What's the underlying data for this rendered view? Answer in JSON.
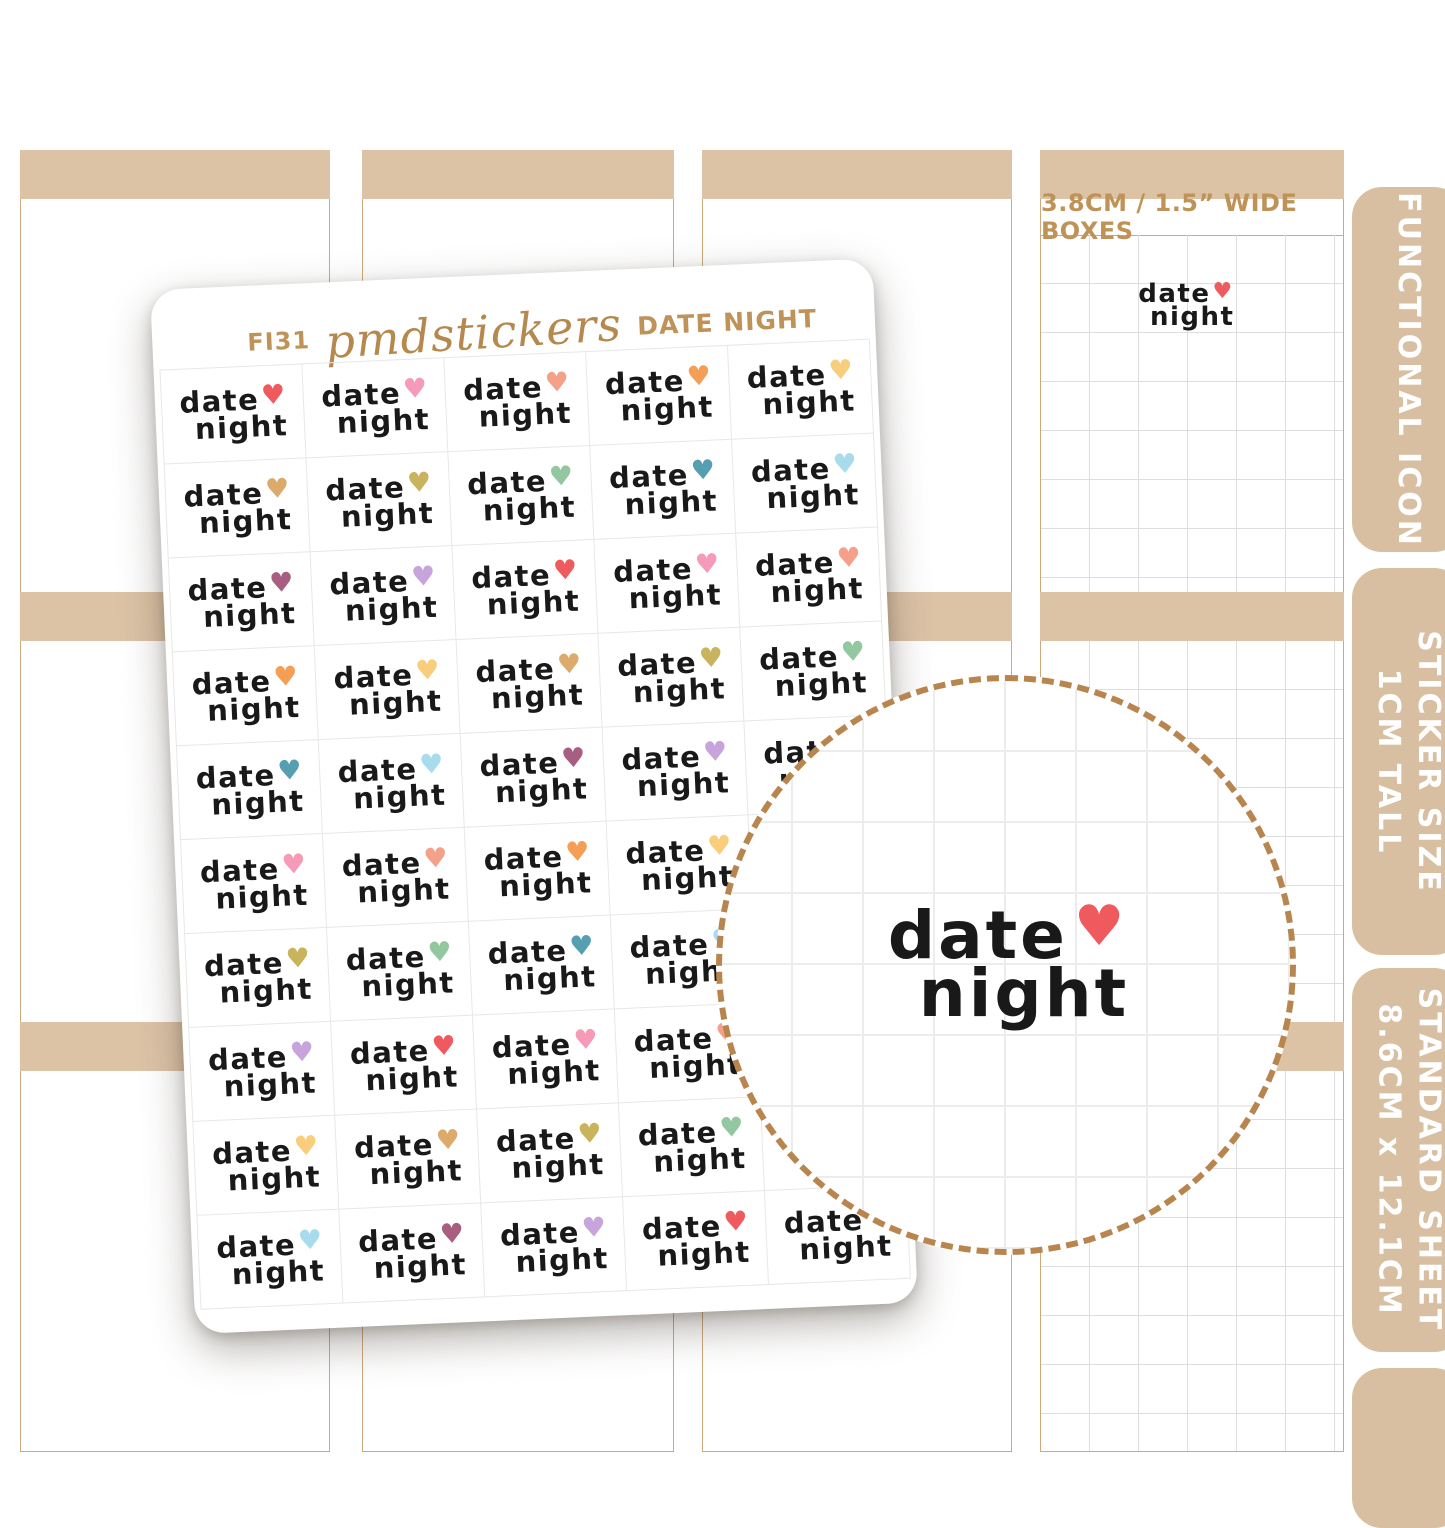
{
  "sheet": {
    "code": "FI31",
    "brand": "pmdstickers",
    "title": "DATE NIGHT",
    "sticker_text_line1": "date",
    "sticker_text_line2": "night",
    "rows": 10,
    "cols": 5,
    "heart_palette": {
      "red": "#ef5a5e",
      "pink": "#f59ab7",
      "salmon": "#f4a189",
      "orange": "#f49e56",
      "yellow": "#f8cd7c",
      "camel": "#dcaa6a",
      "olive": "#c9b35c",
      "sage": "#92c7a0",
      "teal": "#569fb1",
      "sky": "#a8dcec",
      "plum": "#a85e81",
      "lavender": "#c7a5dc"
    },
    "heart_sequence": [
      "red",
      "pink",
      "salmon",
      "orange",
      "yellow",
      "camel",
      "olive",
      "sage",
      "teal",
      "sky",
      "plum",
      "lavender",
      "red",
      "pink",
      "salmon",
      "orange",
      "yellow",
      "camel",
      "olive",
      "sage",
      "teal",
      "sky",
      "plum",
      "lavender",
      "red",
      "pink",
      "salmon",
      "orange",
      "yellow",
      "camel",
      "olive",
      "sage",
      "teal",
      "sky",
      "plum",
      "lavender",
      "red",
      "pink",
      "salmon",
      "orange",
      "yellow",
      "camel",
      "olive",
      "sage",
      "teal",
      "sky",
      "plum",
      "lavender",
      "red",
      "pink"
    ]
  },
  "background_panel": {
    "caption": "3.8CM / 1.5” WIDE BOXES",
    "mini_sticker": {
      "line1": "date",
      "line2": "night",
      "heart": "red"
    }
  },
  "zoom_circle": {
    "big_sticker": {
      "line1": "date",
      "line2": "night",
      "heart": "red"
    }
  },
  "tabs": [
    {
      "lines": [
        "FUNCTIONAL ICON"
      ]
    },
    {
      "lines": [
        "STICKER SIZE",
        "1CM TALL"
      ]
    },
    {
      "lines": [
        "STANDARD SHEET",
        "8.6CM x 12.1CM"
      ]
    },
    {
      "lines": []
    }
  ],
  "icons": {
    "heart": "♥"
  },
  "colors": {
    "planner_tan": "#dcc3a6",
    "tab_tan": "#d9bfa2",
    "border_tan": "#cfa97c",
    "gold_text": "#bf9257",
    "dash_circle": "#b9854e",
    "sticker_ink": "#191919"
  }
}
